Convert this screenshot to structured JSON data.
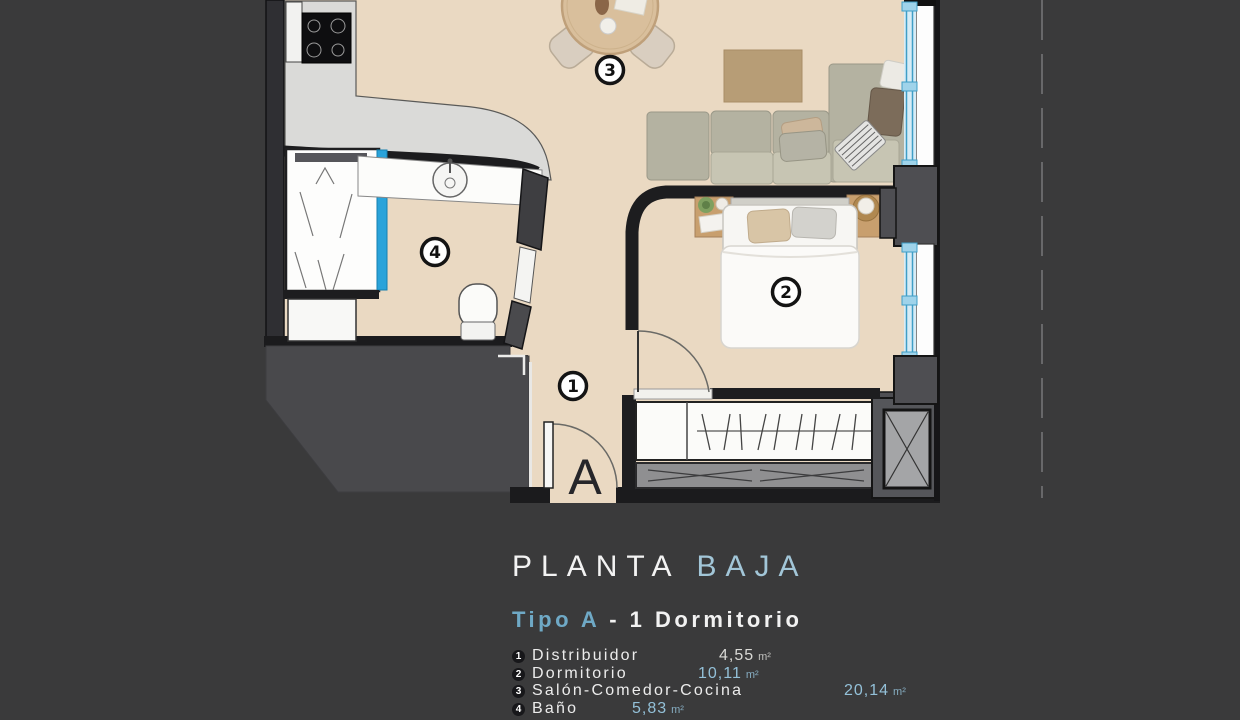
{
  "title": {
    "part1": "PLANTA",
    "part2": "BAJA"
  },
  "subtitle": {
    "part1": "Tipo A",
    "part2": "- 1  Dormitorio"
  },
  "legend": [
    {
      "num": "1",
      "name": "Distribuidor",
      "area": "4,55",
      "unit": "m²"
    },
    {
      "num": "2",
      "name": "Dormitorio",
      "area": "10,11",
      "unit": "m²"
    },
    {
      "num": "3",
      "name": "Salón-Comedor-Cocina",
      "area": "20,14",
      "unit": "m²"
    },
    {
      "num": "4",
      "name": "Baño",
      "area": "5,83",
      "unit": "m²"
    }
  ],
  "plan": {
    "markers": [
      "1",
      "2",
      "3",
      "4"
    ],
    "entrance_label": "A"
  },
  "colors": {
    "background": "#3a3a3b",
    "floor": "#ead9c2",
    "wall": "#1c1c1e",
    "counter_gray": "#dadad8",
    "accent_blue": "#93c0d8",
    "title_blue": "#a2c6d8",
    "shower_glass": "#2aa3da",
    "window_glass": "#d7ecf6",
    "wall_mass_gray": "#4a4a4d"
  }
}
